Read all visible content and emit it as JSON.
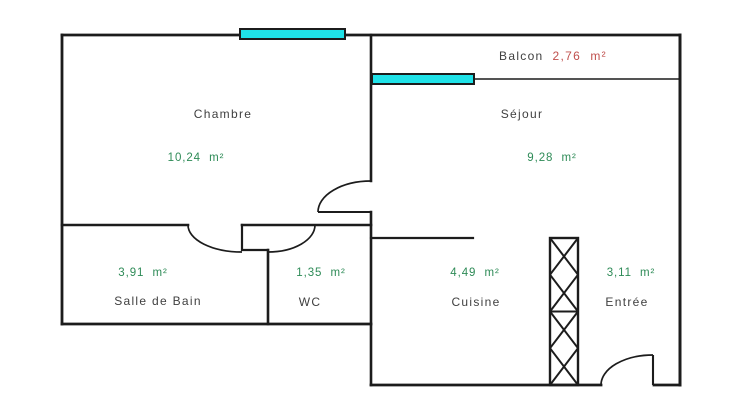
{
  "colors": {
    "background": "#ffffff",
    "wall": "#1c1c1c",
    "room_label": "#3f3f3f",
    "area_value": "#2e8b57",
    "balcony_value": "#c0504d",
    "window_fill": "#1fe2e8"
  },
  "rooms": {
    "chambre": {
      "name": "Chambre",
      "area": "10,24  m²"
    },
    "sejour": {
      "name": "Séjour",
      "area": "9,28  m²"
    },
    "balcon": {
      "name": "Balcon",
      "area": "2,76  m²"
    },
    "salle_de_bain": {
      "name": "Salle de Bain",
      "area": "3,91  m²"
    },
    "wc": {
      "name": "WC",
      "area": "1,35  m²"
    },
    "cuisine": {
      "name": "Cuisine",
      "area": "4,49  m²"
    },
    "entree": {
      "name": "Entrée",
      "area": "3,11  m²"
    }
  }
}
